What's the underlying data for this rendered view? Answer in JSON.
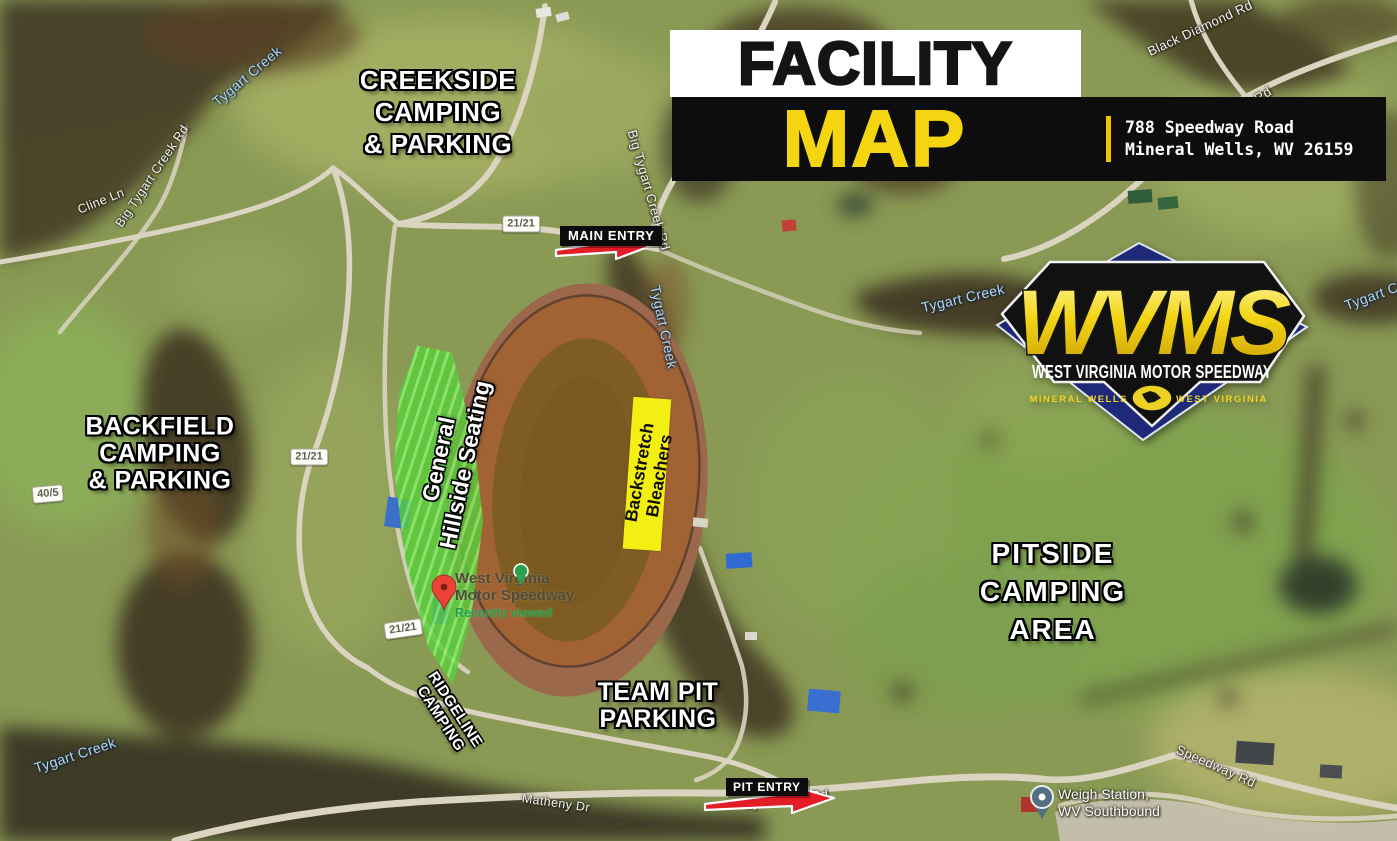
{
  "header": {
    "title_top": "FACILITY",
    "title_bottom": "MAP",
    "address_line1": "788 Speedway Road",
    "address_line2": "Mineral Wells, WV 26159"
  },
  "logo": {
    "initials": "WVMS",
    "name": "WEST VIRGINIA MOTOR SPEEDWAY",
    "city": "MINERAL WELLS",
    "state": "WEST VIRGINIA"
  },
  "areas": {
    "creekside": {
      "lines": [
        "CREEKSIDE",
        "CAMPING",
        "& PARKING"
      ]
    },
    "backfield": {
      "lines": [
        "BACKFIELD",
        "CAMPING",
        "& PARKING"
      ]
    },
    "pitside": {
      "lines": [
        "PITSIDE",
        "CAMPING",
        "AREA"
      ]
    },
    "team_pit": {
      "lines": [
        "TEAM PIT",
        "PARKING"
      ]
    },
    "ridgeline": {
      "lines": [
        "RIDGELINE",
        "CAMPING"
      ]
    },
    "hillside_seating": {
      "lines": [
        "General",
        "Hillside Seating"
      ]
    },
    "backstretch_bleachers": {
      "lines": [
        "Backstretch",
        "Bleachers"
      ]
    }
  },
  "entries": {
    "main": "MAIN ENTRY",
    "pit": "PIT ENTRY"
  },
  "map_labels": {
    "creek": "Tygart Creek",
    "big_tygart_creek_rd": "Big Tygart Creek Rd",
    "black_diamond_rd": "Black Diamond Rd",
    "cline_ln": "Cline Ln",
    "speedway_rd": "Speedway Rd",
    "matheny_dr": "Matheny Dr",
    "route_21": "21/21",
    "route_40": "40/5"
  },
  "poi": {
    "name_line1": "West Virginia",
    "name_line2": "Motor Speedway",
    "status": "Recently viewed"
  },
  "weigh_station": {
    "line1": "Weigh Station,",
    "line2": "WV Southbound"
  },
  "colors": {
    "header_yellow": "#F5D411",
    "arrow_red": "#E31C25",
    "seating_green": "#5CD240",
    "bleacher_yellow": "#F4EF12",
    "logo_navy": "#1E2A78"
  }
}
